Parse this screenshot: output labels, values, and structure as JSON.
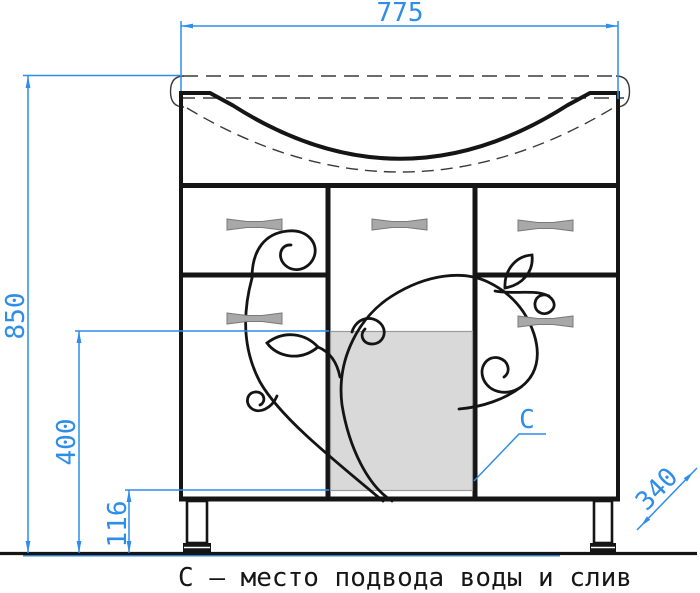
{
  "caption": "С – место подвода воды и слив",
  "marker": {
    "label": "С"
  },
  "dims": {
    "width": "775",
    "height": "850",
    "supply_top": "400",
    "supply_bottom": "116",
    "depth": "340"
  },
  "colors": {
    "dimension_blue": "#2E8DEA",
    "line_black": "#151515",
    "supply_shade": "#D9D9D9",
    "handle_gray": "#A8A8A8"
  }
}
